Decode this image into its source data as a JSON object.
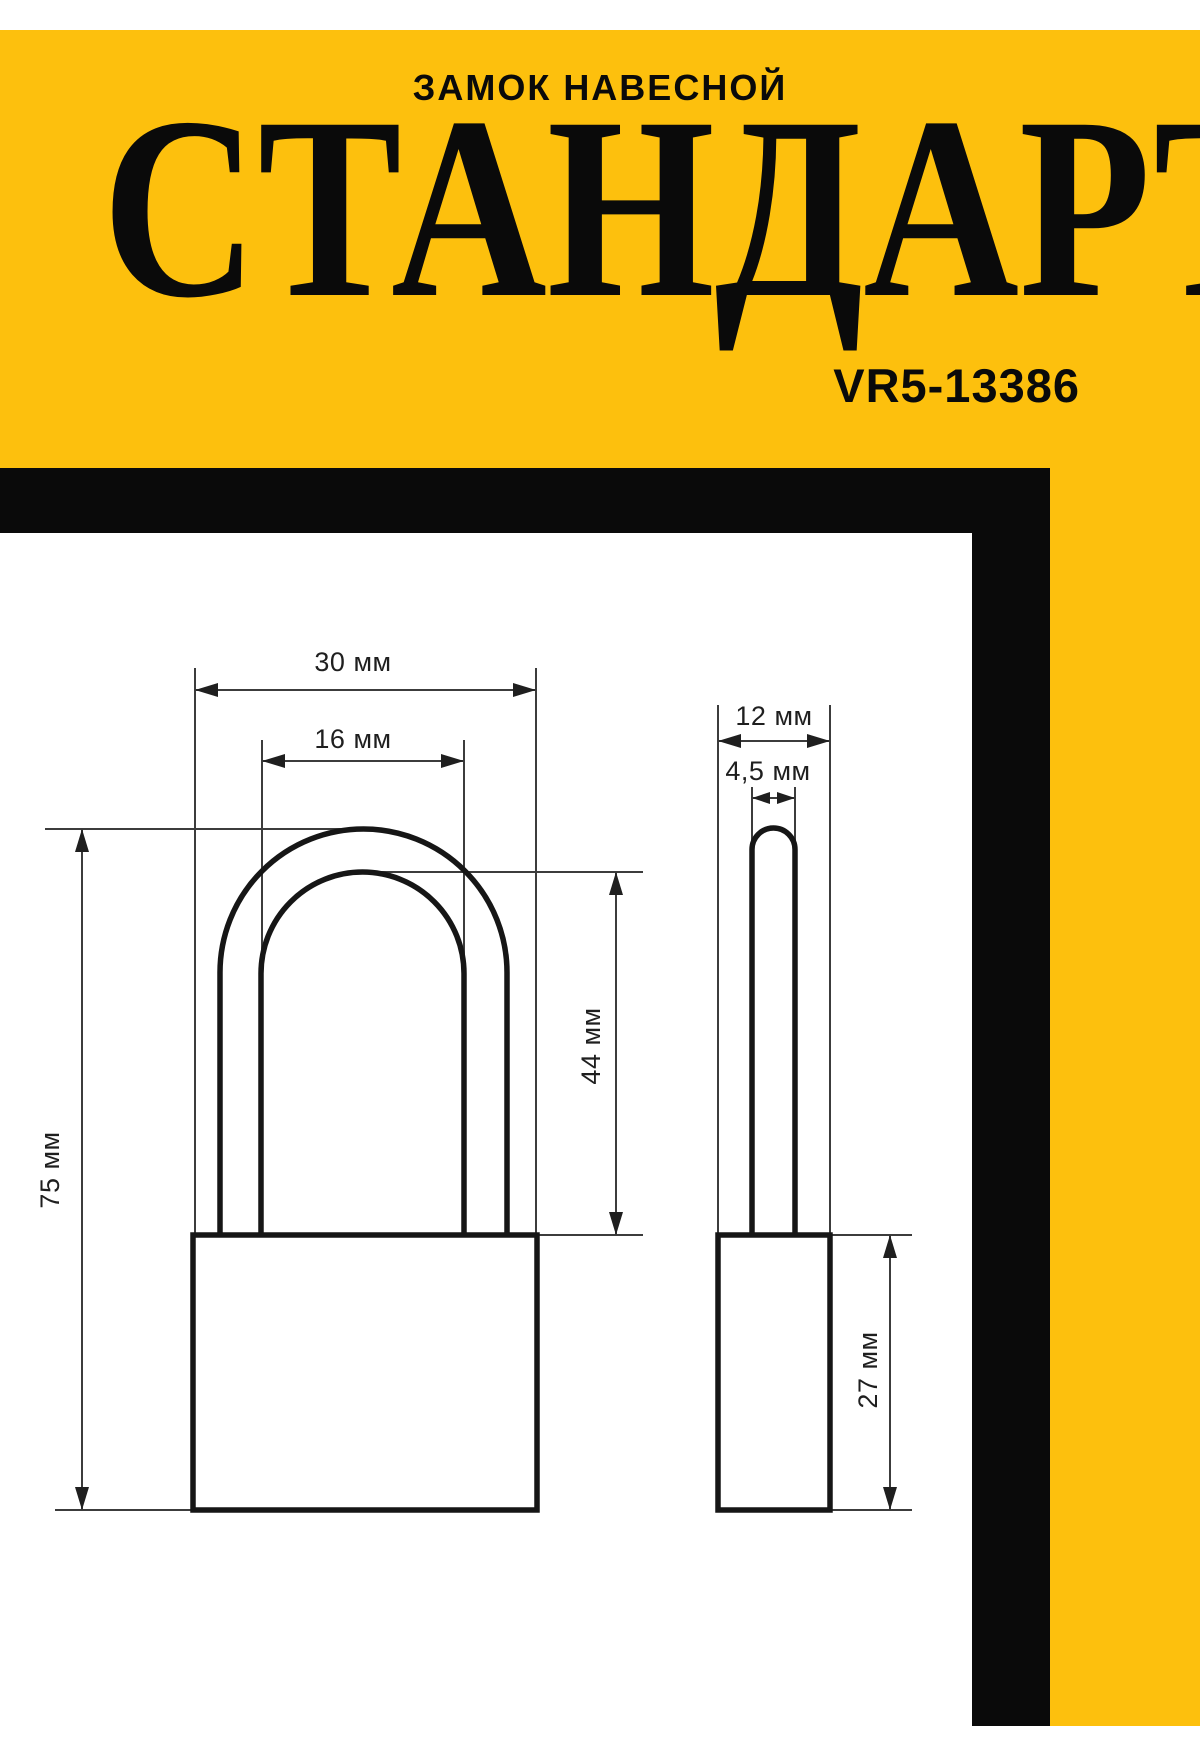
{
  "header": {
    "subtitle": "ЗАМОК НАВЕСНОЙ",
    "title": "СТАНДАРТ",
    "model": "VR5-13386"
  },
  "drawing": {
    "front_view": {
      "body_width_label": "30 мм",
      "shackle_inner_width_label": "16 мм",
      "shackle_height_label": "44 мм",
      "total_height_label": "75 мм"
    },
    "side_view": {
      "body_depth_label": "12 мм",
      "shackle_diameter_label": "4,5 мм",
      "body_height_label": "27 мм"
    }
  },
  "colors": {
    "yellow": "#fdc00d",
    "black": "#0a0a0a",
    "paper": "#ffffff",
    "line": "#161616",
    "thin": "#3c3c3c",
    "text": "#1f1f1f"
  }
}
